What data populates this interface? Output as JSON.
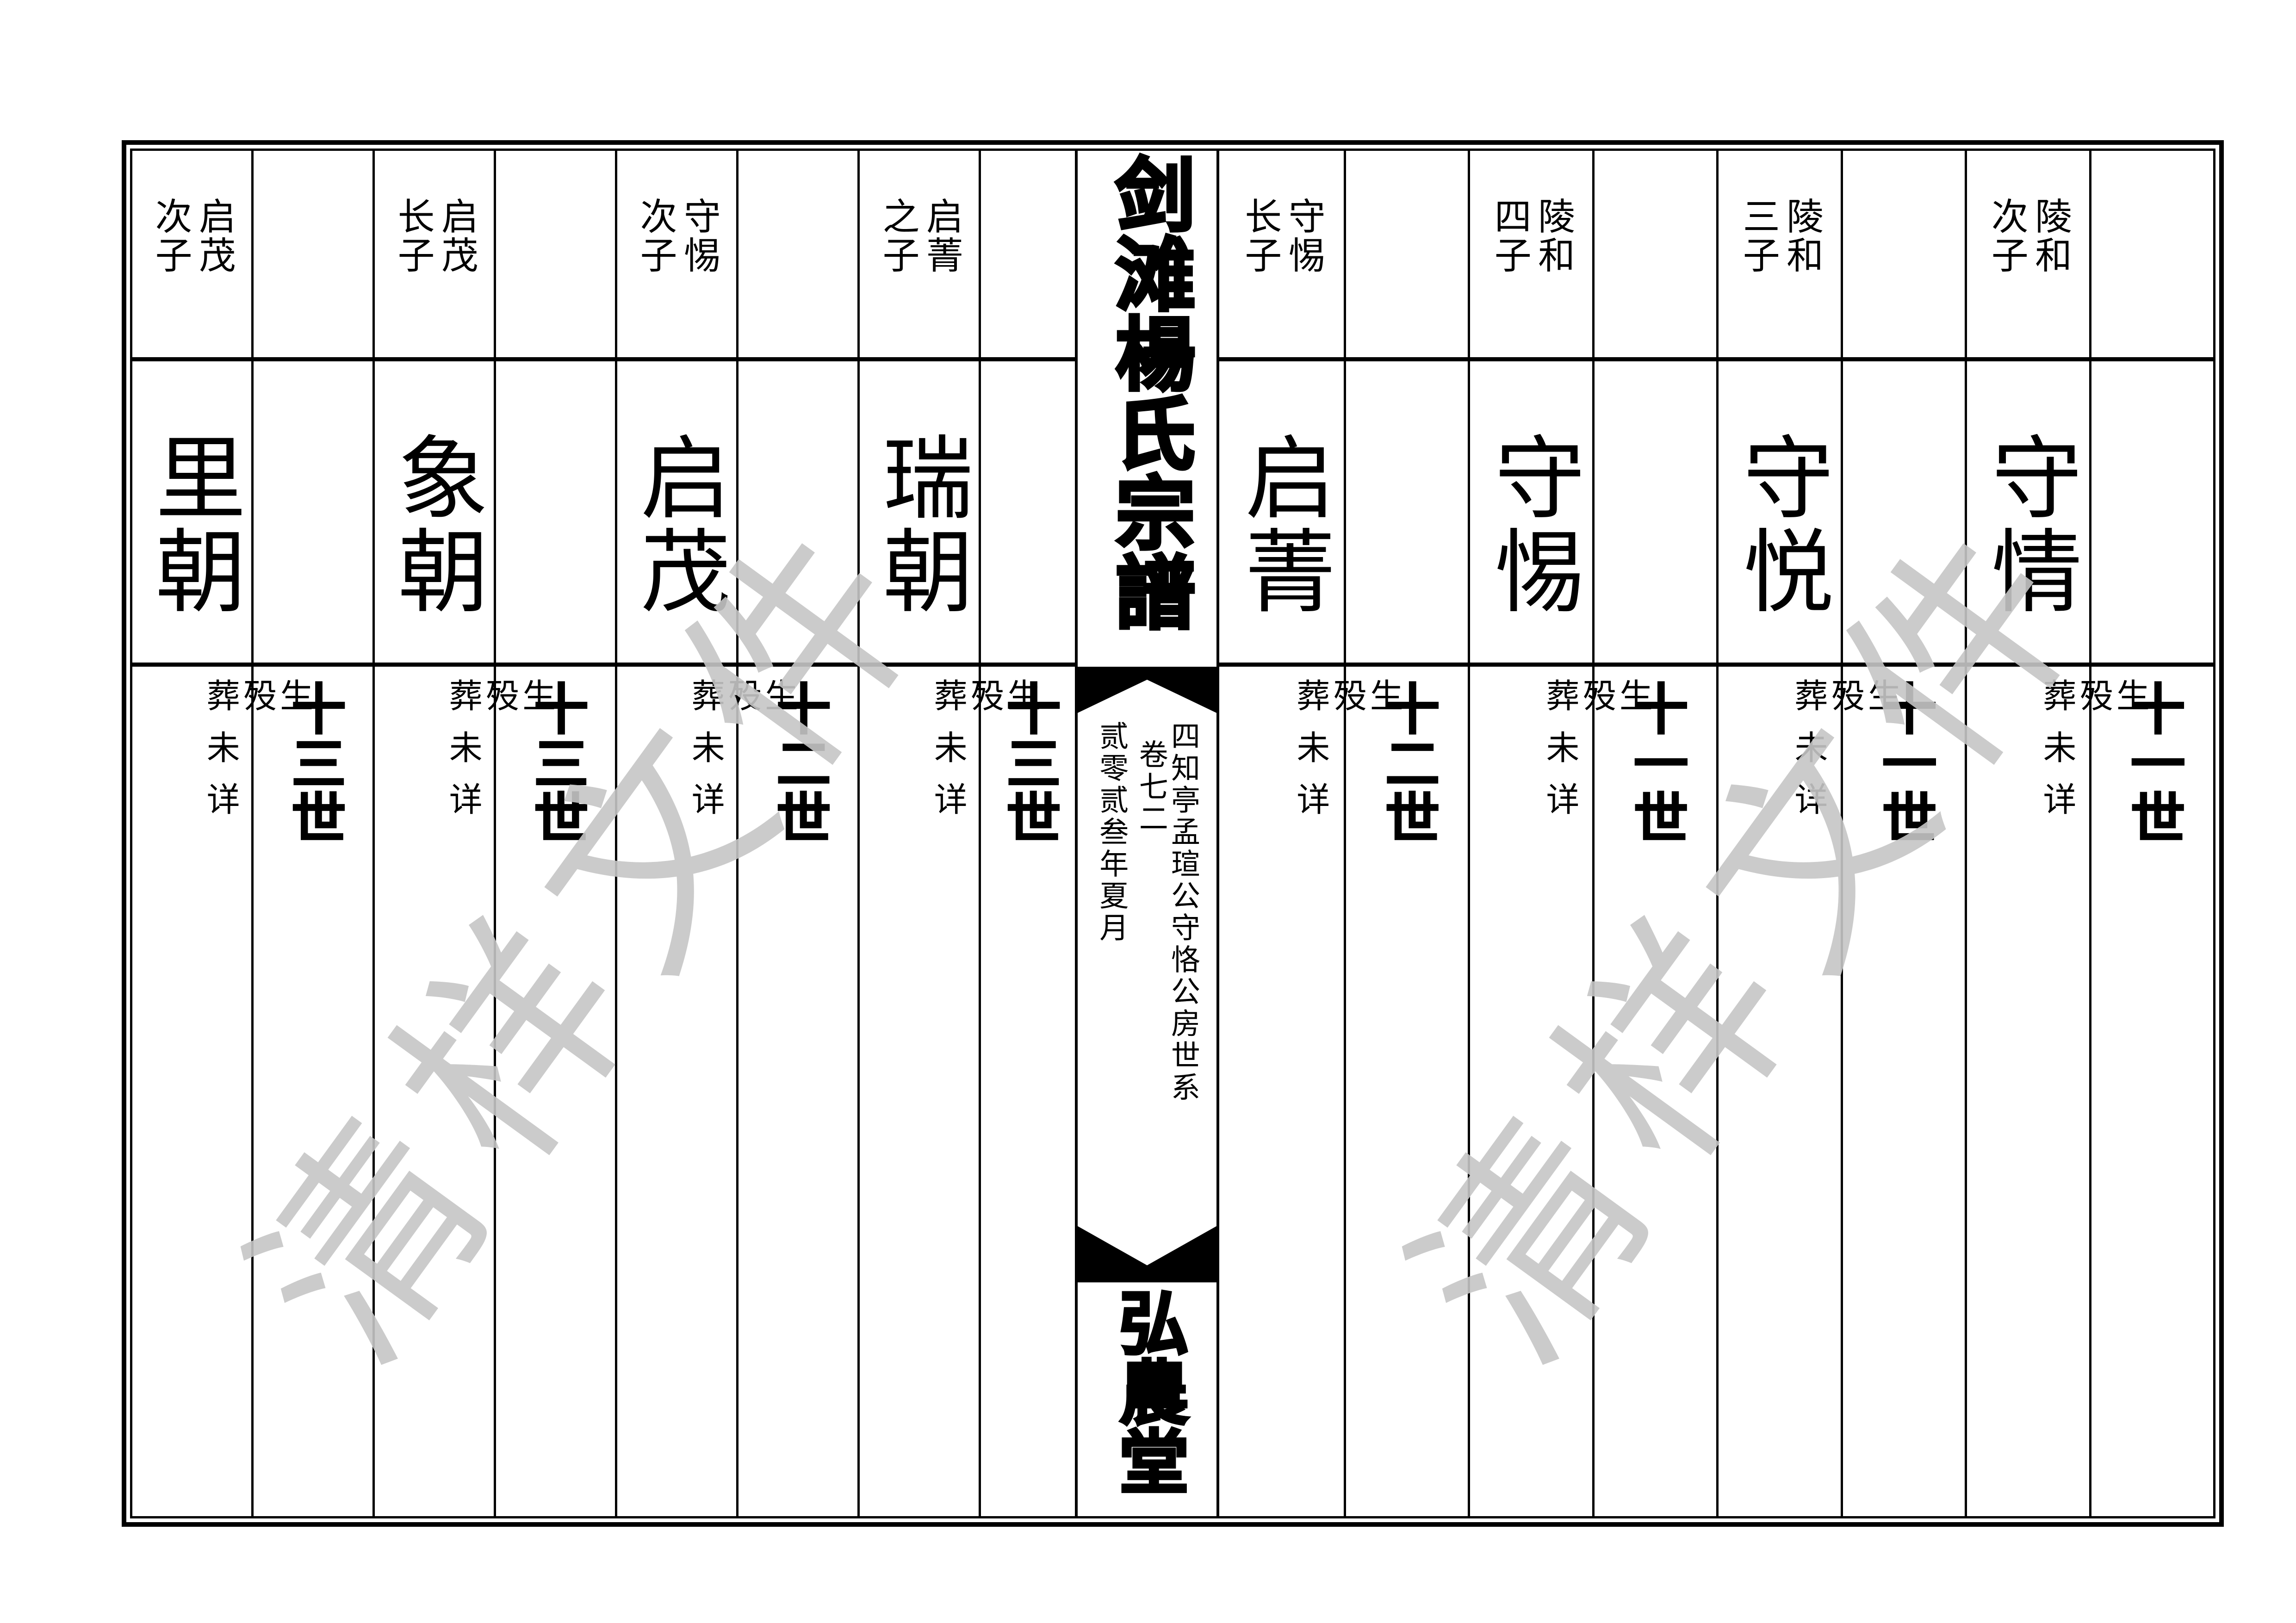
{
  "spine": {
    "title": "剑滩楊氏宗譜",
    "series_line": "四知亭孟瑄公守恪公房世系",
    "volume": "卷七二",
    "date_line": "贰零贰叁年夏月",
    "hall": "弘農堂"
  },
  "watermark": {
    "text": "清样文件",
    "color": "#c6c6c6"
  },
  "details": {
    "birth": "生",
    "death": "殁",
    "burial": "葬未详"
  },
  "left_columns": [
    {
      "parent": "启茂",
      "rank": "次子",
      "name": "里朝",
      "generation": "十三世"
    },
    {
      "parent": "启茂",
      "rank": "长子",
      "name": "象朝",
      "generation": "十三世"
    },
    {
      "parent": "守惕",
      "rank": "次子",
      "name": "启茂",
      "generation": "十二世"
    },
    {
      "parent": "启菁",
      "rank": "之子",
      "name": "瑞朝",
      "generation": "十三世"
    }
  ],
  "right_columns": [
    {
      "parent": "守惕",
      "rank": "长子",
      "name": "启菁",
      "generation": "十二世"
    },
    {
      "parent": "陵和",
      "rank": "四子",
      "name": "守惕",
      "generation": "十一世"
    },
    {
      "parent": "陵和",
      "rank": "三子",
      "name": "守悦",
      "generation": "十一世"
    },
    {
      "parent": "陵和",
      "rank": "次子",
      "name": "守情",
      "generation": "十一世"
    }
  ]
}
